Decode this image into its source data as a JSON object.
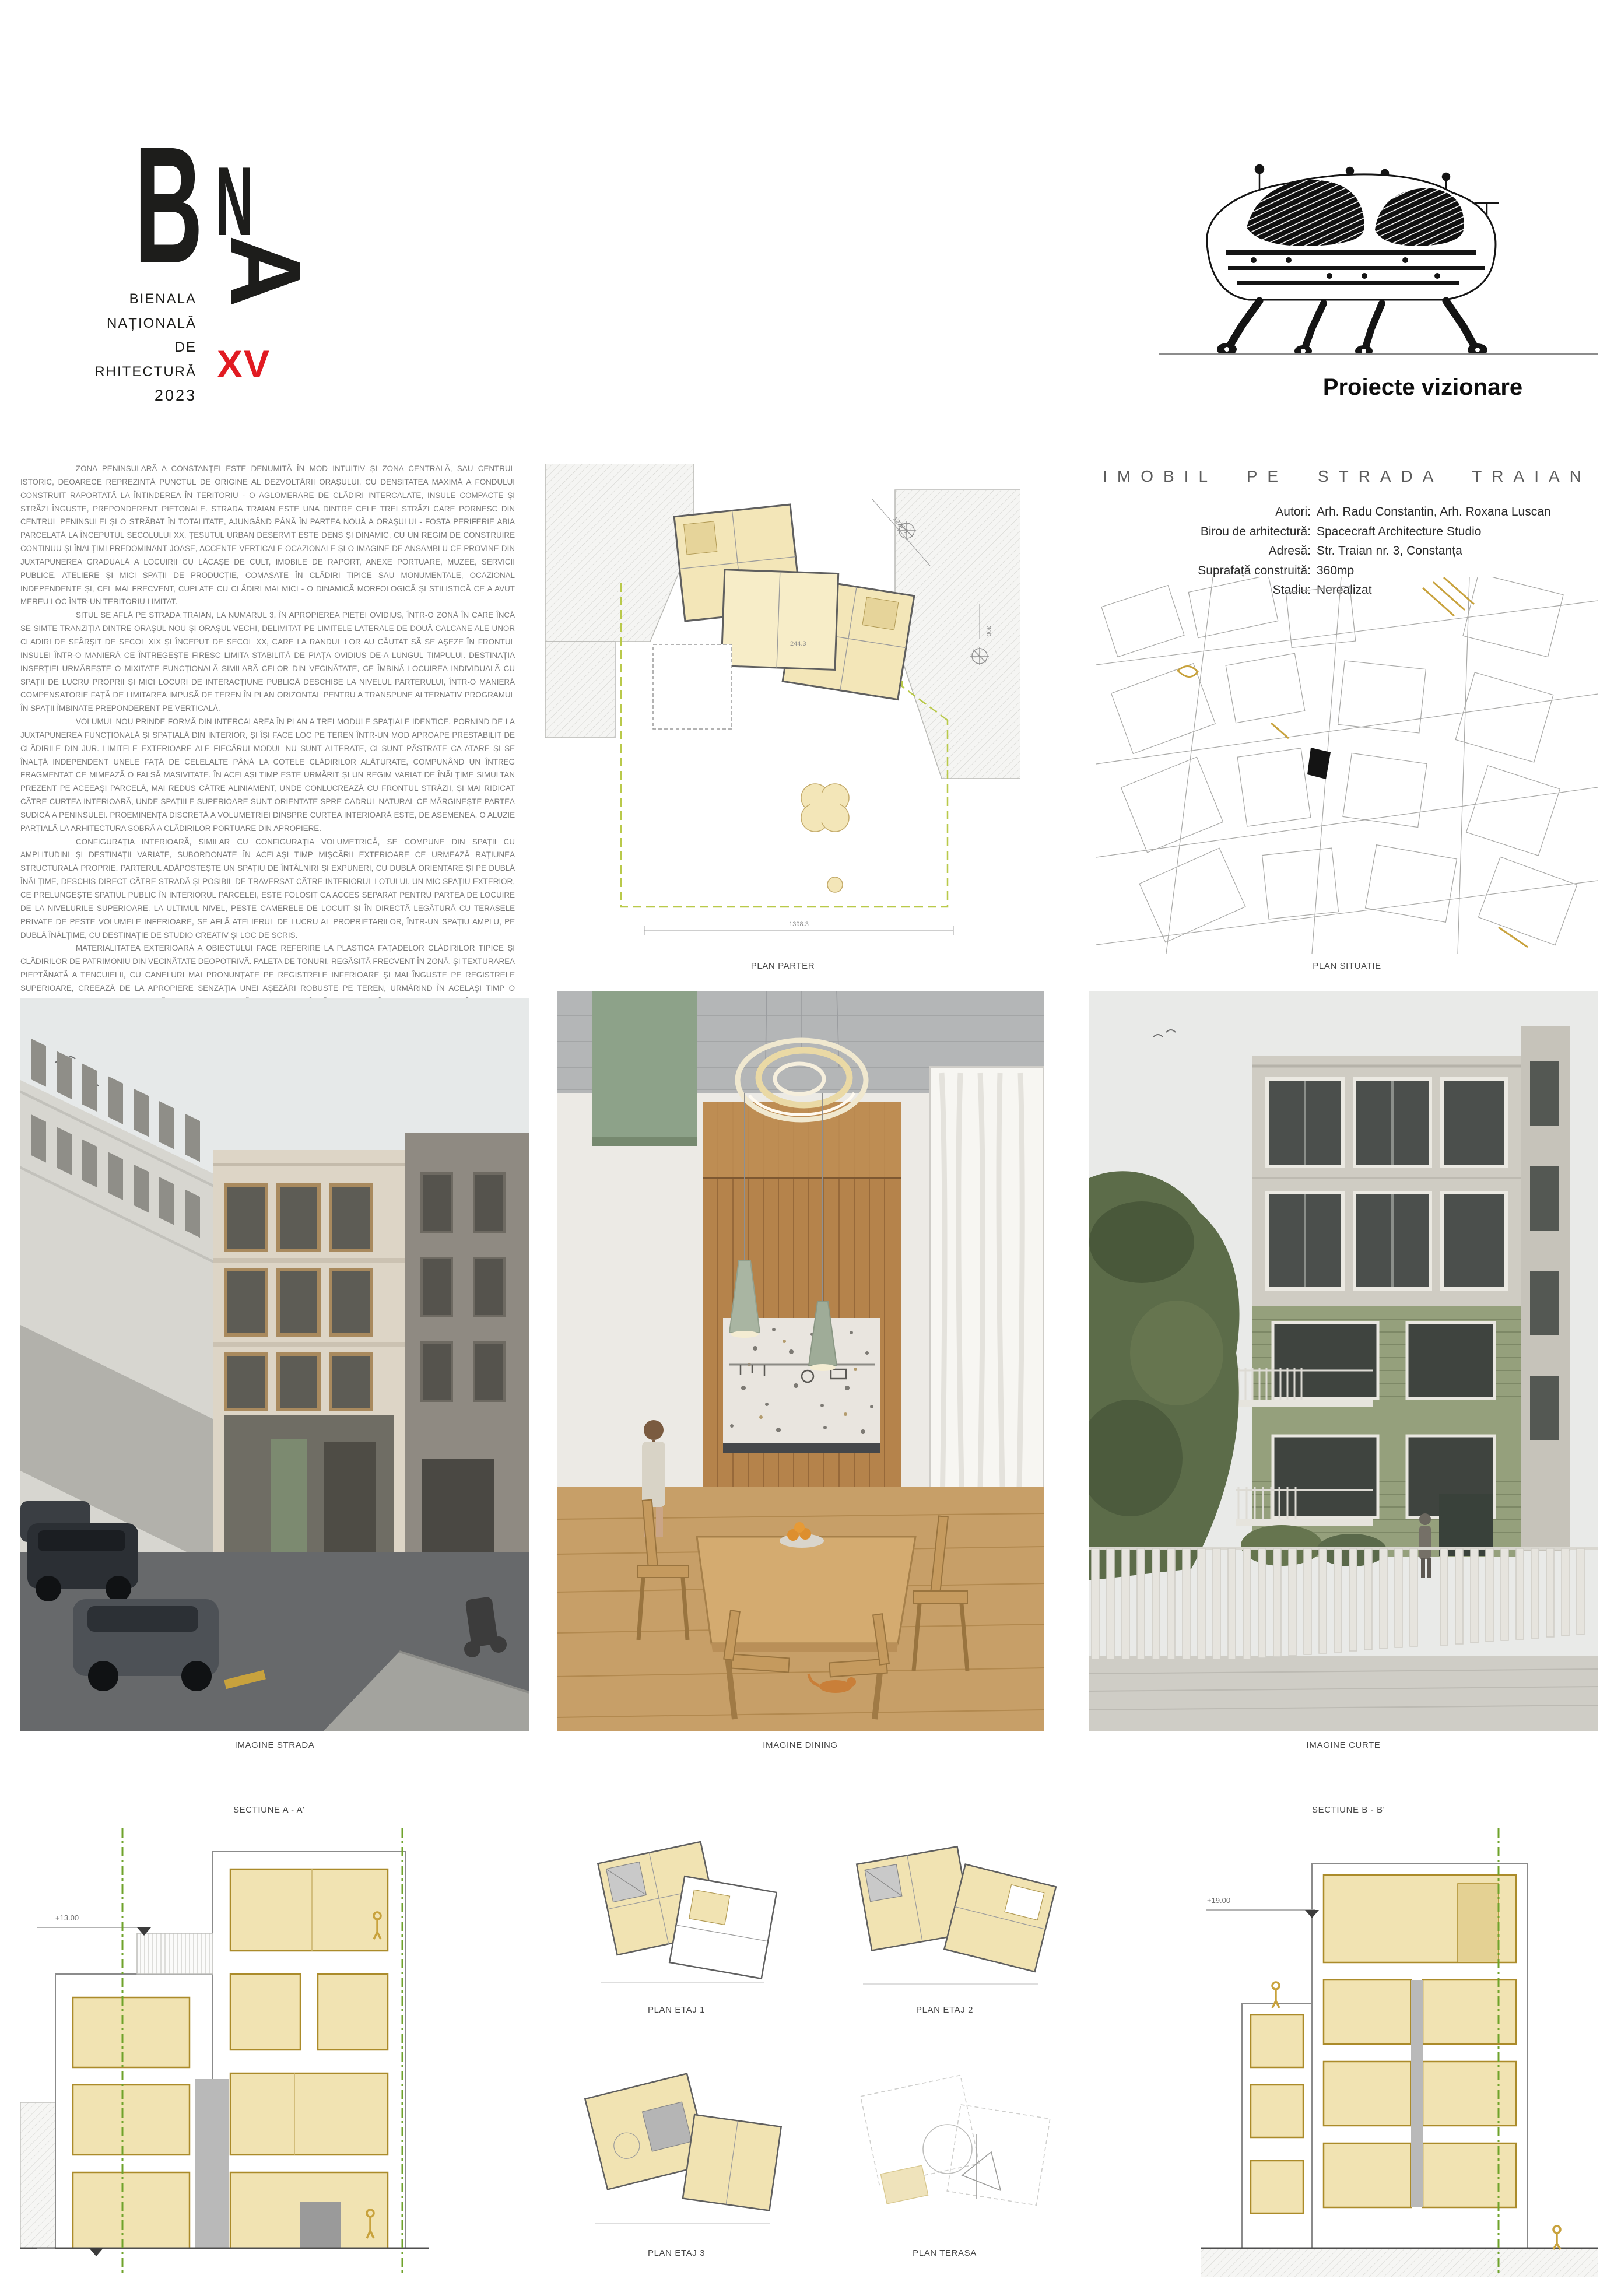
{
  "logo": {
    "b": "B",
    "n": "N",
    "a": "A",
    "line1": "BIENALA",
    "line2": "NAȚIONALĂ",
    "line3": "DE",
    "line4": "ARHITECTURĂ",
    "edition": "XV",
    "year": "2023"
  },
  "category": {
    "label": "Proiecte vizionare"
  },
  "essay": {
    "paragraphs": [
      "ZONA PENINSULARĂ A CONSTANȚEI ESTE DENUMITĂ ÎN MOD INTUITIV ȘI ZONA CENTRALĂ, SAU CENTRUL ISTORIC, DEOARECE REPREZINTĂ PUNCTUL DE ORIGINE AL DEZVOLTĂRII ORAȘULUI, CU DENSITATEA MAXIMĂ A FONDULUI CONSTRUIT RAPORTATĂ LA ÎNTINDEREA ÎN TERITORIU - O AGLOMERARE DE CLĂDIRI INTERCALATE, INSULE COMPACTE ȘI STRĂZI ÎNGUSTE, PREPONDERENT PIETONALE. STRADA TRAIAN ESTE UNA DINTRE CELE TREI STRĂZI CARE PORNESC DIN CENTRUL PENINSULEI ȘI O STRĂBAT ÎN TOTALITATE, AJUNGÂND PÂNĂ ÎN PARTEA NOUĂ A ORAȘULUI - FOSTA PERIFERIE ABIA PARCELATĂ LA ÎNCEPUTUL SECOLULUI XX. ȚESUTUL URBAN DESERVIT ESTE DENS ȘI DINAMIC, CU UN REGIM DE CONSTRUIRE CONTINUU ȘI ÎNALȚIMI PREDOMINANT JOASE, ACCENTE VERTICALE OCAZIONALE ȘI O IMAGINE DE ANSAMBLU CE PROVINE DIN JUXTAPUNEREA GRADUALĂ A LOCUIRII CU LĂCAȘE DE CULT, IMOBILE DE RAPORT, ANEXE PORTUARE, MUZEE, SERVICII PUBLICE, ATELIERE ȘI MICI SPAȚII DE PRODUCȚIE, COMASATE ÎN CLĂDIRI TIPICE SAU MONUMENTALE, OCAZIONAL INDEPENDENTE ȘI, CEL MAI FRECVENT, CUPLATE CU CLĂDIRI MAI MICI - O DINAMICĂ MORFOLOGICĂ ȘI STILISTICĂ CE A AVUT MEREU LOC ÎNTR-UN TERITORIU LIMITAT.",
      "SITUL SE AFLĂ PE STRADA TRAIAN, LA NUMARUL 3, ÎN APROPIEREA PIEȚEI OVIDIUS, ÎNTR-O ZONĂ ÎN CARE ÎNCĂ SE SIMTE TRANZIȚIA DINTRE ORAȘUL NOU ȘI ORAȘUL VECHI, DELIMITAT PE LIMITELE LATERALE DE DOUĂ CALCANE ALE UNOR CLADIRI DE SFÂRȘIT DE SECOL XIX ȘI ÎNCEPUT DE SECOL XX, CARE LA RANDUL LOR AU CĂUTAT SĂ SE AȘEZE ÎN FRONTUL INSULEI ÎNTR-O MANIERĂ CE ÎNTREGEȘTE FIRESC LIMITA STABILITĂ DE PIAȚA OVIDIUS DE-A LUNGUL TIMPULUI. DESTINAȚIA INSERȚIEI URMĂREȘTE O MIXITATE FUNCȚIONALĂ SIMILARĂ CELOR DIN VECINĂTATE, CE ÎMBINĂ LOCUIREA INDIVIDUALĂ CU SPAȚII DE LUCRU PROPRII ȘI MICI LOCURI DE INTERACȚIUNE PUBLICĂ DESCHISE LA NIVELUL PARTERULUI, ÎNTR-O MANIERĂ COMPENSATORIE FAȚĂ DE LIMITAREA IMPUSĂ DE TEREN ÎN PLAN ORIZONTAL PENTRU A TRANSPUNE ALTERNATIV PROGRAMUL ÎN SPAȚII ÎMBINATE PREPONDERENT PE VERTICALĂ.",
      "VOLUMUL NOU PRINDE FORMĂ DIN INTERCALAREA ÎN PLAN A TREI MODULE SPAȚIALE IDENTICE, PORNIND DE LA JUXTAPUNEREA FUNCȚIONALĂ ȘI SPAȚIALĂ DIN INTERIOR, ȘI ÎȘI FACE LOC PE TEREN ÎNTR-UN MOD APROAPE PRESTABILIT DE CLĂDIRILE DIN JUR. LIMITELE EXTERIOARE ALE FIECĂRUI MODUL NU SUNT ALTERATE, CI SUNT PĂSTRATE CA ATARE ȘI SE ÎNALȚĂ INDEPENDENT UNELE FAȚĂ DE CELELALTE PÂNĂ LA COTELE CLĂDIRILOR ALĂTURATE, COMPUNÂND UN ÎNTREG FRAGMENTAT CE MIMEAZĂ O FALSĂ MASIVITATE. ÎN ACELAȘI TIMP ESTE URMĂRIT ȘI UN REGIM VARIAT DE ÎNĂLȚIME SIMULTAN PREZENT PE ACEEAȘI PARCELĂ, MAI REDUS CĂTRE ALINIAMENT, UNDE CONLUCREAZĂ CU FRONTUL STRĂZII, ȘI MAI RIDICAT CĂTRE CURTEA INTERIOARĂ, UNDE SPAȚIILE SUPERIOARE SUNT ORIENTATE SPRE CADRUL NATURAL CE MĂRGINEȘTE PARTEA SUDICĂ A PENINSULEI. PROEMINENȚA DISCRETĂ A VOLUMETRIEI DINSPRE CURTEA INTERIOARĂ ESTE, DE ASEMENEA, O ALUZIE PARȚIALĂ LA ARHITECTURA SOBRĂ A CLĂDIRILOR PORTUARE DIN APROPIERE.",
      "CONFIGURAȚIA INTERIOARĂ, SIMILAR CU CONFIGURAȚIA VOLUMETRICĂ, SE COMPUNE DIN SPAȚII CU AMPLITUDINI ȘI DESTINAȚII VARIATE, SUBORDONATE ÎN ACELAȘI TIMP MIȘCĂRII EXTERIOARE CE URMEAZĂ RAȚIUNEA STRUCTURALĂ PROPRIE. PARTERUL ADĂPOSTEȘTE UN SPAȚIU DE ÎNTÂLNIRI ȘI EXPUNERI, CU DUBLĂ ORIENTARE ȘI PE DUBLĂ ÎNĂLȚIME, DESCHIS DIRECT CĂTRE STRADĂ ȘI POSIBIL DE TRAVERSAT CĂTRE INTERIORUL LOTULUI. UN MIC SPAȚIU EXTERIOR, CE PRELUNGEȘTE SPATIUL PUBLIC ÎN INTERIORUL PARCELEI, ESTE FOLOSIT CA ACCES SEPARAT PENTRU PARTEA DE LOCUIRE DE LA NIVELURILE SUPERIOARE. LA ULTIMUL NIVEL, PESTE CAMERELE DE LOCUIT ȘI ÎN DIRECTĂ LEGĂTURĂ CU TERASELE PRIVATE DE PESTE VOLUMELE INFERIOARE, SE AFLĂ ATELIERUL DE LUCRU AL PROPRIETARILOR, ÎNTR-UN SPAȚIU AMPLU, PE DUBLĂ ÎNĂLȚIME, CU DESTINAȚIE DE STUDIO CREATIV ȘI LOC DE SCRIS.",
      "MATERIALITATEA EXTERIOARĂ A OBIECTULUI FACE REFERIRE LA PLASTICA FAȚADELOR CLĂDIRILOR TIPICE ȘI CLĂDIRILOR DE PATRIMONIU DIN VECINĂTATE DEOPOTRIVĂ. PALETA DE TONURI, REGĂSITĂ FRECVENT ÎN ZONĂ, ȘI TEXTURAREA PIEPTĂNATĂ A TENCUIELII, CU CANELURI MAI PRONUNȚATE PE REGISTRELE INFERIOARE ȘI MAI ÎNGUSTE PE REGISTRELE SUPERIOARE, CREEAZĂ DE LA APROPIERE SENZAȚIA UNEI AȘEZĂRI ROBUSTE PE TEREN, URMĂRIND ÎN ACELAȘI TIMP O EXPRESIE DE ANSAMBLU UNIFORMĂ, APARENT MIMETICĂ, CE PERMITE ÎNSĂ, DE LA DEPĂRTARE, DIZOLVAREA ÎN PEISAJUL STILISTIC ȘI CROMATIC AL PENINSULEI."
    ]
  },
  "project": {
    "title": "IMOBIL PE STRADA TRAIAN",
    "credits": [
      {
        "label": "Autori:",
        "value": "Arh. Radu Constantin, Arh. Roxana Luscan"
      },
      {
        "label": "Birou de arhitectură:",
        "value": "Spacecraft Architecture Studio"
      },
      {
        "label": "Adresă:",
        "value": "Str. Traian nr. 3, Constanța"
      },
      {
        "label": "Suprafață construită:",
        "value": "360mp"
      },
      {
        "label": "Stadiu:",
        "value": "Nerealizat"
      }
    ]
  },
  "captions": {
    "plan_parter": "PLAN PARTER",
    "plan_situatie": "PLAN SITUATIE",
    "imagine_strada": "IMAGINE STRADA",
    "imagine_dining": "IMAGINE DINING",
    "imagine_curte": "IMAGINE CURTE",
    "sectiune_a": "SECTIUNE A - A'",
    "sectiune_b": "SECTIUNE B - B'",
    "plan_etaj_1": "PLAN ETAJ 1",
    "plan_etaj_2": "PLAN ETAJ 2",
    "plan_etaj_3": "PLAN ETAJ 3",
    "plan_terasa": "PLAN TERASA"
  },
  "annotations": {
    "elev_plus13": "+13.00",
    "elev_plus19": "+19.00",
    "elev_zero": "+0.00",
    "dim_top": "1227.3",
    "dim_bottom": "1398.3",
    "dim_300": "300",
    "dim_244": "244.3"
  },
  "colors": {
    "accent_red": "#e11b22",
    "plan_beige": "#f1e3b2",
    "plan_olive": "#ab8b2a",
    "section_line_green": "#6fa32b",
    "figure_gold": "#c8a23c",
    "essay_gray": "#7a7a7a"
  }
}
